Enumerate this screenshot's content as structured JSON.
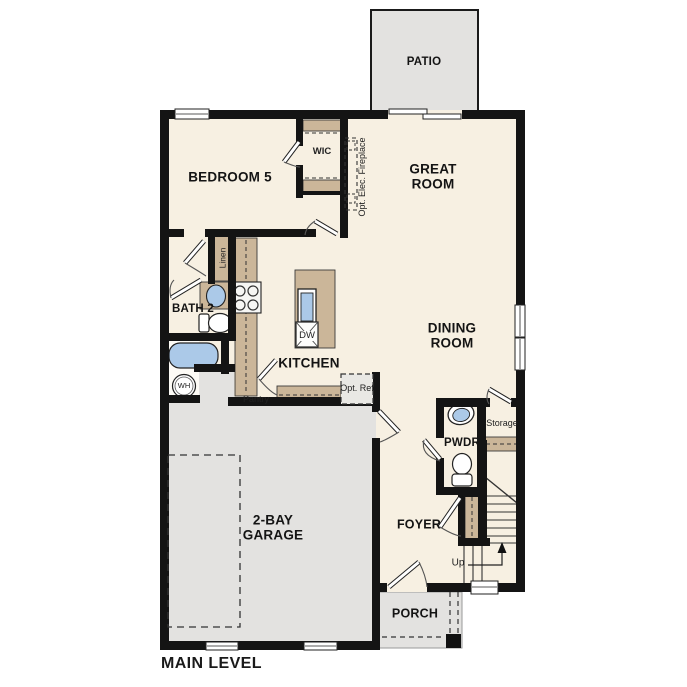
{
  "plan_title": "MAIN LEVEL",
  "colors": {
    "floor": "#f7f0e2",
    "hard": "#e3e2e0",
    "cabinet": "#cbb699",
    "fixture": "#abc9e8",
    "wall": "#141414",
    "line": "#333333"
  },
  "rooms": {
    "patio": "PATIO",
    "great_room": "GREAT ROOM",
    "bedroom5": "BEDROOM 5",
    "wic": "WIC",
    "bath2": "BATH 2",
    "kitchen": "KITCHEN",
    "dining_room": "DINING ROOM",
    "pwdr": "PWDR",
    "storage": "Storage",
    "foyer": "FOYER",
    "garage": "2-BAY GARAGE",
    "porch": "PORCH"
  },
  "annotations": {
    "fireplace": "Opt. Elec. Fireplace",
    "linen": "Linen",
    "pantry": "Pantry",
    "opt_ref": "Opt. Ref",
    "dw": "DW",
    "wh": "WH",
    "up": "Up"
  }
}
